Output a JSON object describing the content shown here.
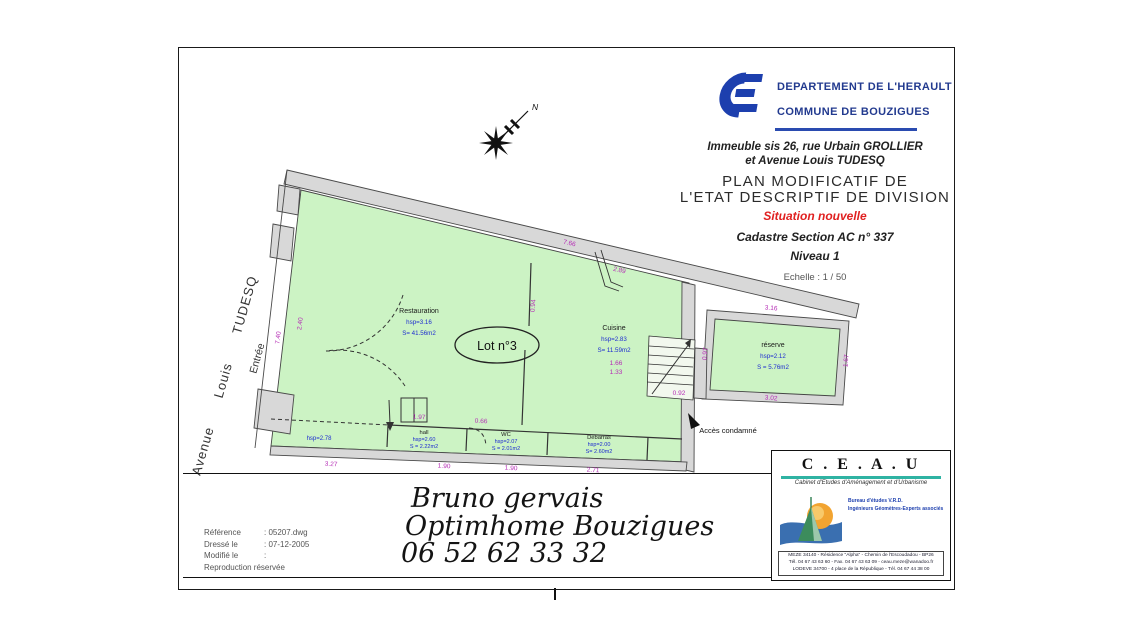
{
  "header": {
    "department": "DEPARTEMENT DE L'HERAULT",
    "commune": "COMMUNE DE BOUZIGUES",
    "address_line1": "Immeuble sis 26, rue Urbain GROLLIER",
    "address_line2": "et Avenue Louis TUDESQ",
    "title_line1": "PLAN  MODIFICATIF DE",
    "title_line2": "L'ETAT DESCRIPTIF DE DIVISION",
    "status": "Situation nouvelle",
    "cadastre": "Cadastre Section AC n° 337",
    "level": "Niveau 1",
    "scale": "Echelle : 1 / 50"
  },
  "plan": {
    "lot_label": "Lot n°3",
    "north_label": "N",
    "street_label": "Avenue Louis TUDESQ",
    "entrance_label": "Entrée",
    "access_note": "Accès condamné",
    "rooms": [
      {
        "name": "Restauration",
        "hsp": "hsp=3.16",
        "area": "S= 41.56m2"
      },
      {
        "name": "Cuisine",
        "hsp": "hsp=2.83",
        "area": "S= 11.59m2"
      },
      {
        "name": "réserve",
        "hsp": "hsp=2.12",
        "area": "S = 5.76m2"
      },
      {
        "name": "hall",
        "hsp": "hsp=2.60",
        "area": "S = 2.22m2"
      },
      {
        "name": "WC",
        "hsp": "hsp=2.07",
        "area": "S = 2.01m2"
      },
      {
        "name": "Débarras",
        "hsp": "hsp=2.00",
        "area": "S= 2.60m2"
      },
      {
        "name": "",
        "hsp": "hsp=2.78",
        "area": ""
      }
    ],
    "dimensions": [
      "7.66",
      "2.89",
      "7.40",
      "2.40",
      "3.16",
      "0.97",
      "1.67",
      "3.02",
      "0.92",
      "3.27",
      "1.90",
      "1.90",
      "2.71",
      "1.97",
      "0.66",
      "0.94",
      "1.66",
      "1.33"
    ]
  },
  "signature": {
    "line1": "Bruno gervais",
    "line2": "Optimhome Bouzigues",
    "line3": "06 52 62 33 32"
  },
  "reference_block": {
    "rows": [
      {
        "label": "Référence",
        "value": ": 05207.dwg"
      },
      {
        "label": "Dressé le",
        "value": ": 07-12-2005"
      },
      {
        "label": "Modifié le",
        "value": ":"
      },
      {
        "label": "Reproduction réservée",
        "value": ""
      }
    ]
  },
  "firm": {
    "name": "C . E . A . U",
    "subtitle": "Cabinet d'Etudes d'Aménagement et d'Urbanisme",
    "line1": "Bureau d'études V.R.D.",
    "line2": "Ingénieurs Géomètres-Experts associés",
    "address1": "MEZE 34140 - Résidence \"Alpha\" - Chemin de l'Escoudadou - BP26",
    "address2": "Tél. 04 67 43 63 60 - Fax. 04 67 43 63 09 - ceau.meze@wanadoo.fr",
    "address3": "LODEVE 34700 - 4 place de la République - Tél. 04 67 44 38 00"
  },
  "colors": {
    "room_green": "#ccf3c4",
    "wall_gray": "#d8d8d8",
    "dimension_magenta": "#b52cb5",
    "room_text_blue": "#1d2bd0",
    "header_blue": "#223a8f",
    "logo_blue": "#1d3fae",
    "status_red": "#e02020",
    "firm_teal": "#2fb3a3"
  }
}
